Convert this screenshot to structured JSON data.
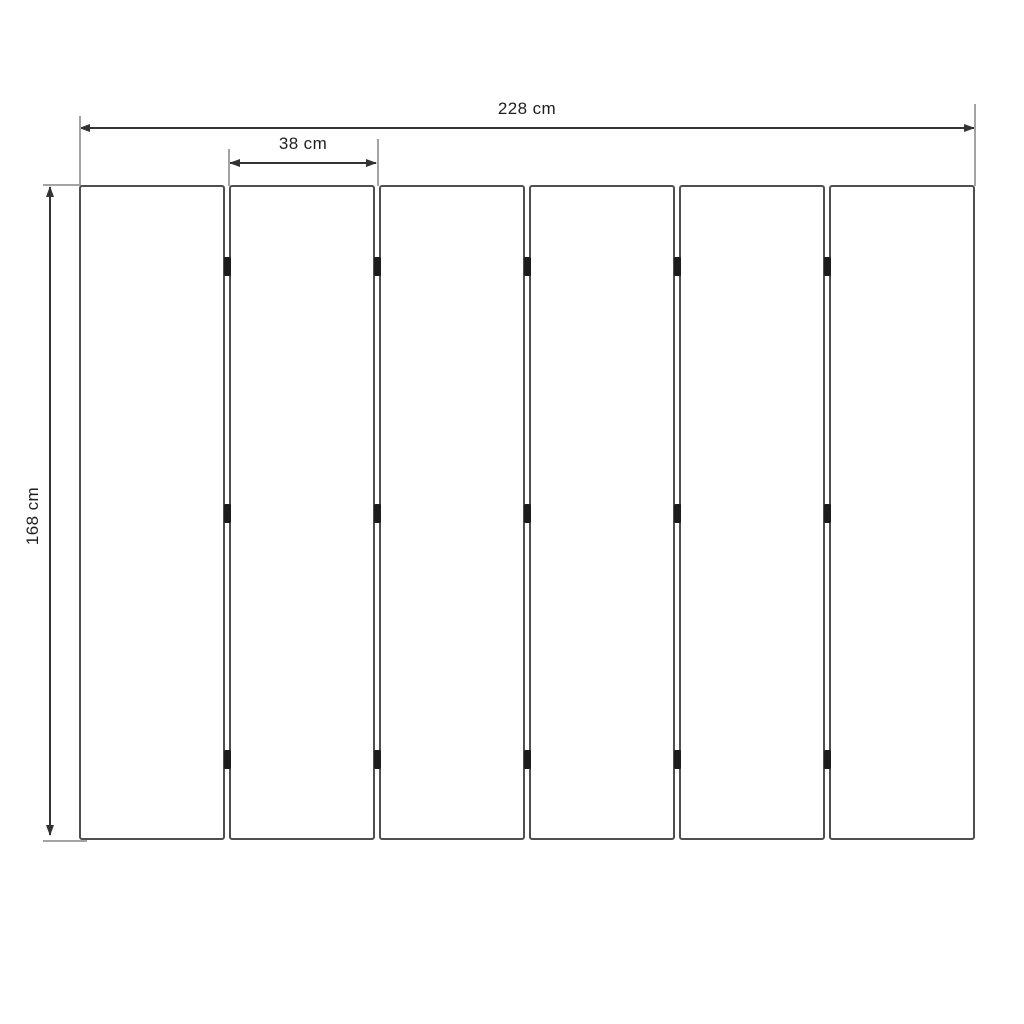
{
  "diagram": {
    "panel_count": 6,
    "dimensions": {
      "total_width_cm": 228,
      "panel_width_cm": 38,
      "height_cm": 168,
      "unit": "cm"
    },
    "labels": {
      "total_width": "228 cm",
      "panel_width": "38 cm",
      "height": "168 cm"
    },
    "hinges": {
      "per_gap": 3,
      "rows_y_px": [
        257,
        504,
        750
      ]
    },
    "colors": {
      "background": "#ffffff",
      "panel_border": "#4f4f4f",
      "panel_fill": "#ffffff",
      "dimension_line": "#333333",
      "extension_line": "#a3a3a3",
      "hinge": "#1c1c1c",
      "text": "#1f1f1f"
    }
  }
}
